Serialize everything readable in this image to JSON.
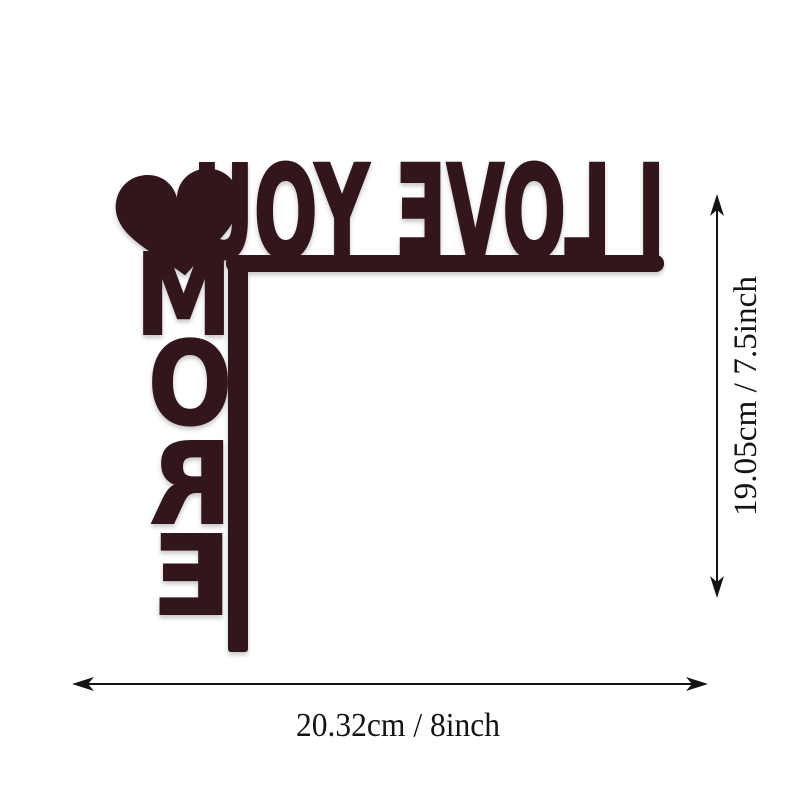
{
  "page": {
    "background_color": "#ffffff"
  },
  "sign": {
    "horizontal_text": "I LOVE YOU",
    "vertical_text": "MORE",
    "vertical_letters": [
      "M",
      "O",
      "R",
      "E"
    ],
    "color": "#31191d"
  },
  "dimensions": {
    "height_label": "19.05cm / 7.5inch",
    "width_label": "20.32cm / 8inch",
    "arrow_color": "#141414"
  }
}
